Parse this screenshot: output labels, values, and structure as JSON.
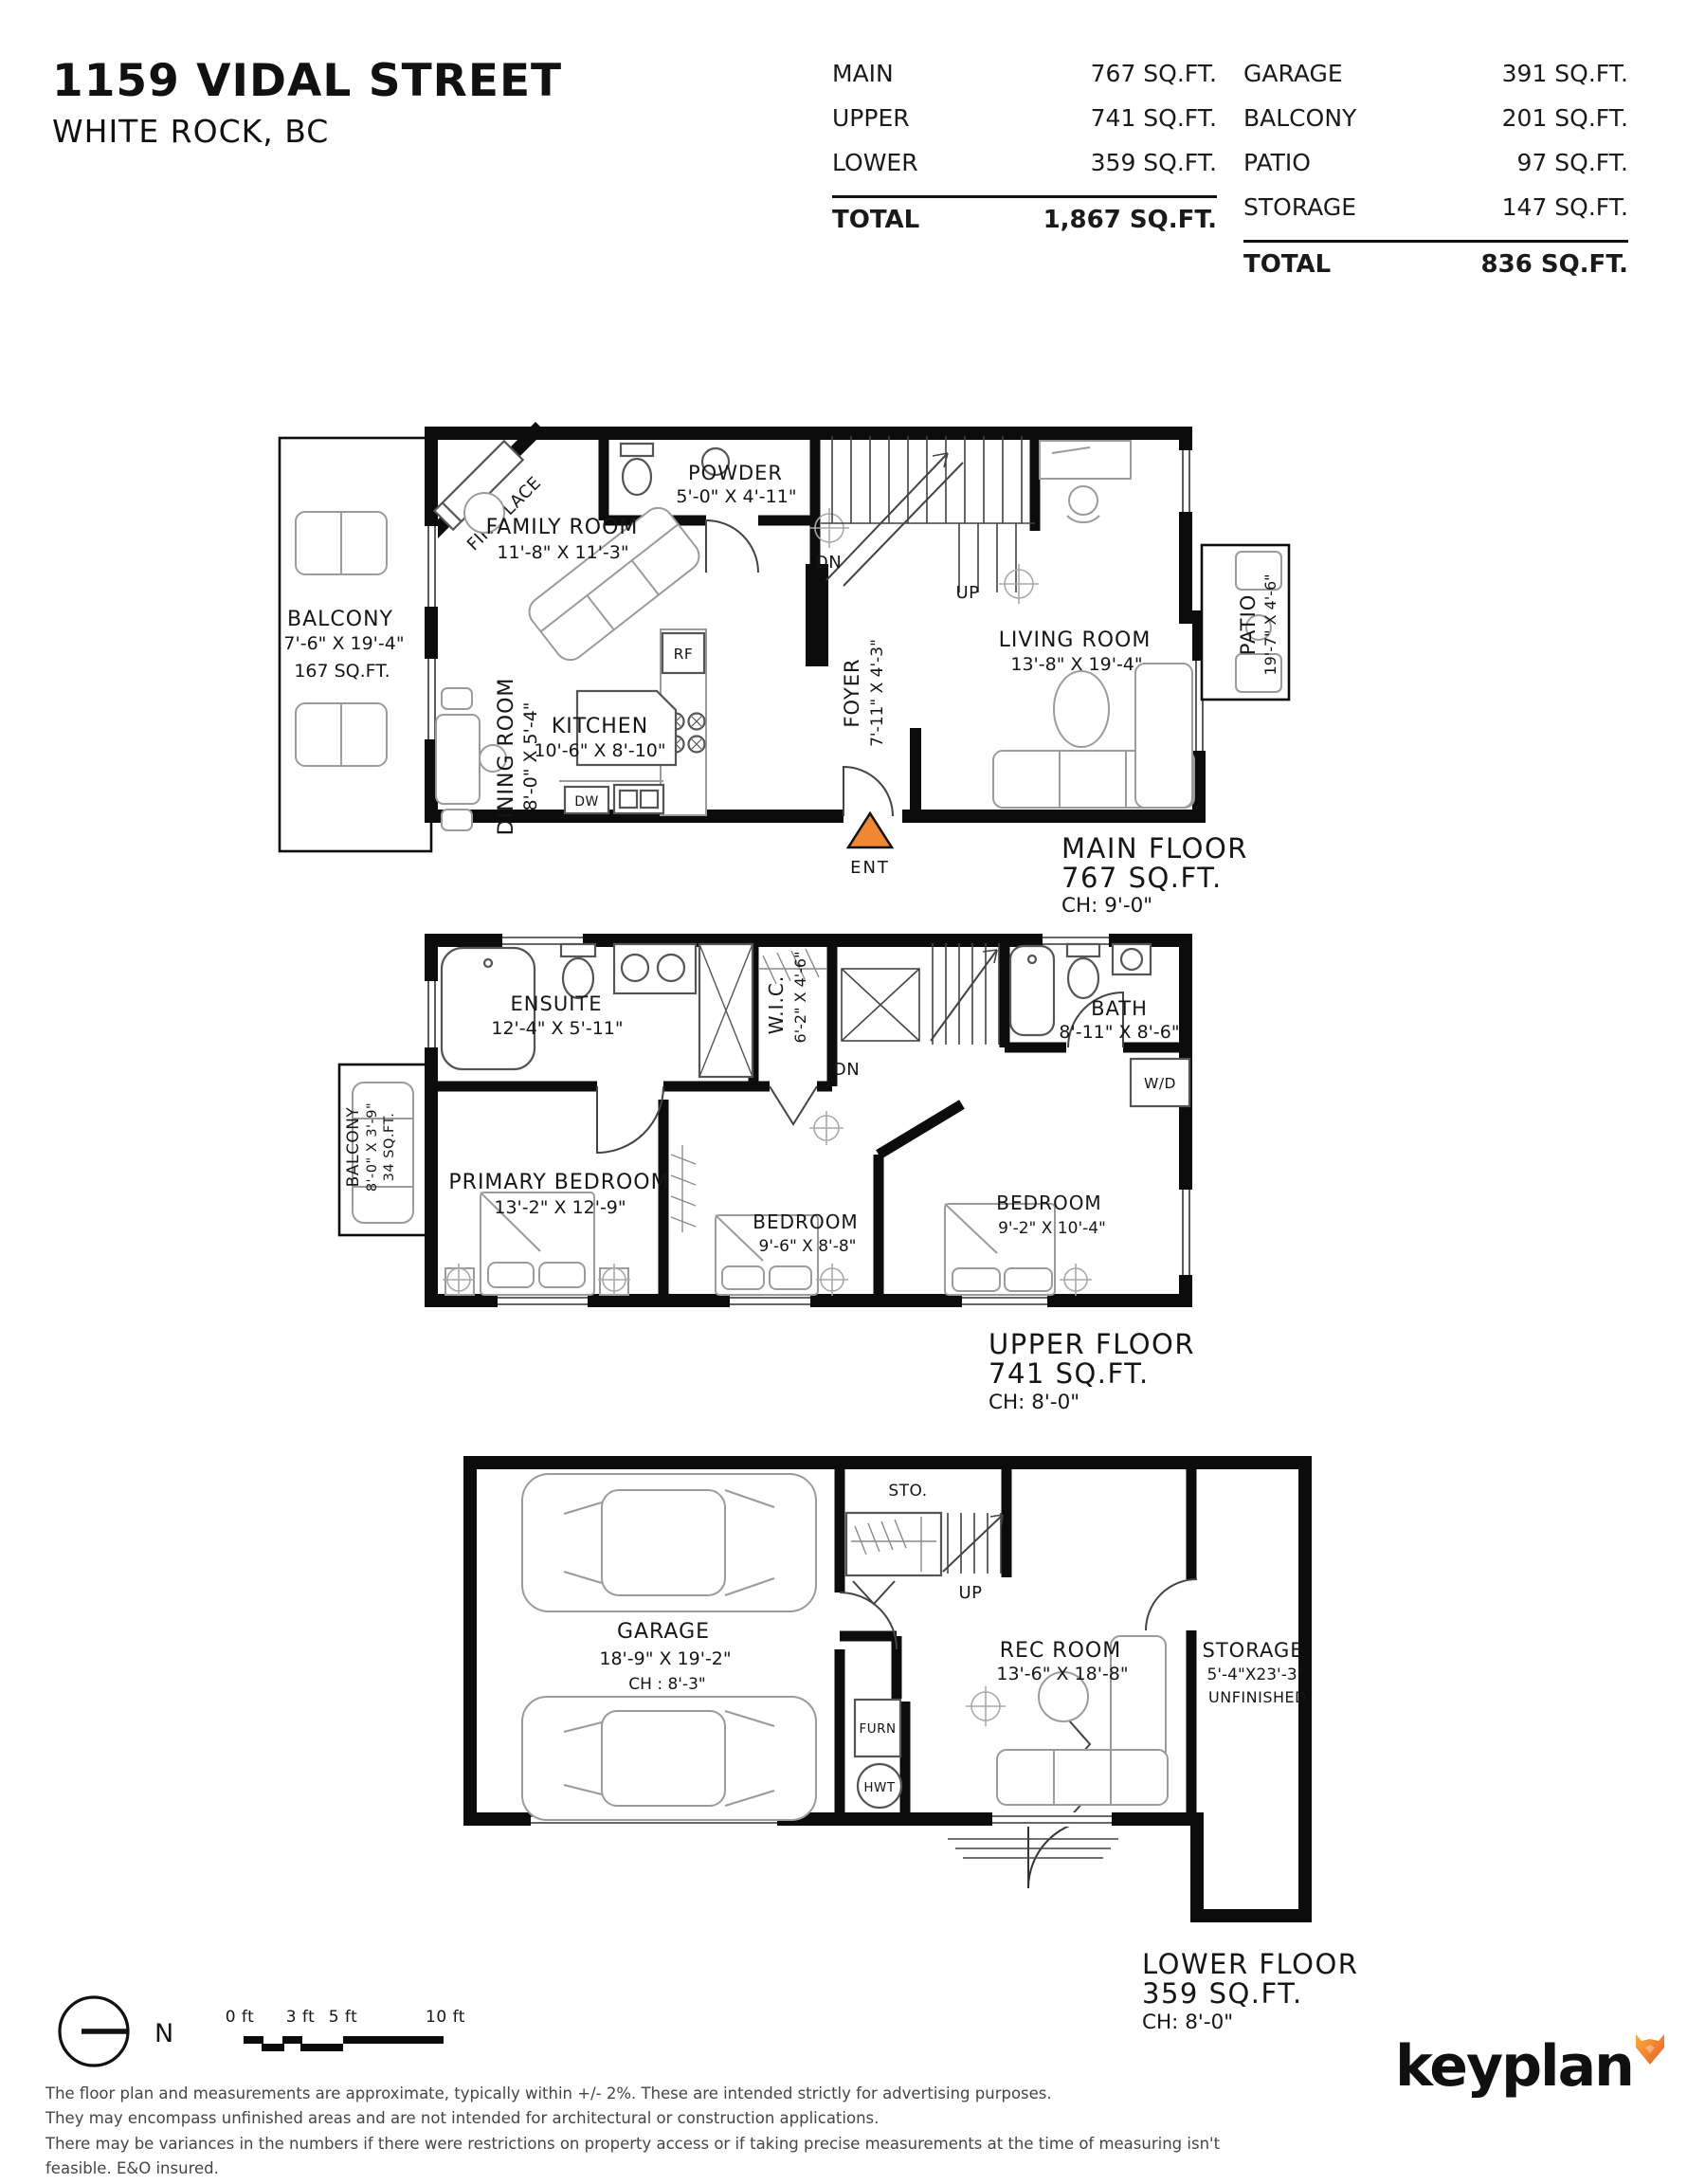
{
  "header": {
    "address_line1": "1159 VIDAL STREET",
    "address_line2": "WHITE ROCK, BC",
    "table_left": {
      "rows": [
        {
          "label": "MAIN",
          "value": "767 SQ.FT."
        },
        {
          "label": "UPPER",
          "value": "741 SQ.FT."
        },
        {
          "label": "LOWER",
          "value": "359 SQ.FT."
        }
      ],
      "total_label": "TOTAL",
      "total_value": "1,867 SQ.FT."
    },
    "table_right": {
      "rows": [
        {
          "label": "GARAGE",
          "value": "391 SQ.FT."
        },
        {
          "label": "BALCONY",
          "value": "201 SQ.FT."
        },
        {
          "label": "PATIO",
          "value": "97 SQ.FT."
        },
        {
          "label": "STORAGE",
          "value": "147 SQ.FT."
        }
      ],
      "total_label": "TOTAL",
      "total_value": "836 SQ.FT."
    }
  },
  "main_floor": {
    "title": "MAIN FLOOR",
    "area": "767 SQ.FT.",
    "ceiling": "CH: 9'-0\"",
    "balcony": {
      "name": "BALCONY",
      "dims": "7'-6\" X 19'-4\"",
      "area": "167 SQ.FT."
    },
    "fireplace": "FIREPLACE",
    "family_room": {
      "name": "FAMILY ROOM",
      "dims": "11'-8\" X 11'-3\""
    },
    "powder": {
      "name": "POWDER",
      "dims": "5'-0\" X 4'-11\""
    },
    "dining": {
      "name": "DINING ROOM",
      "dims": "8'-0\" X 5'-4\""
    },
    "kitchen": {
      "name": "KITCHEN",
      "dims": "10'-6\" X 8'-10\""
    },
    "foyer": {
      "name": "FOYER",
      "dims": "7'-11\" X 4'-3\""
    },
    "living_room": {
      "name": "LIVING ROOM",
      "dims": "13'-8\" X 19'-4\""
    },
    "patio": {
      "name": "PATIO",
      "dims": "19'-7\" X 4'-6\""
    },
    "labels": {
      "dn": "DN",
      "up": "UP",
      "rf": "RF",
      "dw": "DW",
      "ent": "ENT"
    }
  },
  "upper_floor": {
    "title": "UPPER FLOOR",
    "area": "741 SQ.FT.",
    "ceiling": "CH: 8'-0\"",
    "ensuite": {
      "name": "ENSUITE",
      "dims": "12'-4\" X 5'-11\""
    },
    "wic": {
      "name": "W.I.C.",
      "dims": "6'-2\" X 4'-6\""
    },
    "bath": {
      "name": "BATH",
      "dims": "8'-11\" X 8'-6\""
    },
    "balcony": {
      "name": "BALCONY",
      "dims": "8'-0\" X 3'-9\"",
      "area": "34 SQ.FT."
    },
    "primary": {
      "name": "PRIMARY BEDROOM",
      "dims": "13'-2\" X 12'-9\""
    },
    "bedroom2": {
      "name": "BEDROOM",
      "dims": "9'-6\" X 8'-8\""
    },
    "bedroom3": {
      "name": "BEDROOM",
      "dims": "9'-2\" X 10'-4\""
    },
    "labels": {
      "dn": "DN",
      "wd": "W/D"
    }
  },
  "lower_floor": {
    "title": "LOWER FLOOR",
    "area": "359 SQ.FT.",
    "ceiling": "CH: 8'-0\"",
    "garage": {
      "name": "GARAGE",
      "dims": "18'-9\" X 19'-2\"",
      "ceiling": "CH : 8'-3\""
    },
    "rec_room": {
      "name": "REC ROOM",
      "dims": "13'-6\" X 18'-8\""
    },
    "storage": {
      "name": "STORAGE",
      "dims": "5'-4\"X23'-3\"",
      "note": "UNFINISHED"
    },
    "labels": {
      "sto": "STO.",
      "up": "UP",
      "furn": "FURN",
      "hwt": "HWT"
    }
  },
  "footer": {
    "north_label": "N",
    "scale_labels": [
      "0 ft",
      "3 ft",
      "5 ft",
      "10 ft"
    ],
    "disclaimer": [
      "The floor plan and measurements are approximate, typically within +/- 2%. These are intended strictly for advertising purposes.",
      "They may encompass unfinished areas and are not intended for architectural or construction applications.",
      "There may be variances in the numbers if there were restrictions on property access or if taking precise measurements at the time of measuring isn't feasible. E&O insured."
    ],
    "logo_text": "keyplan"
  },
  "colors": {
    "accent_orange": "#EF8733",
    "wall_black": "#0c0c0c"
  }
}
